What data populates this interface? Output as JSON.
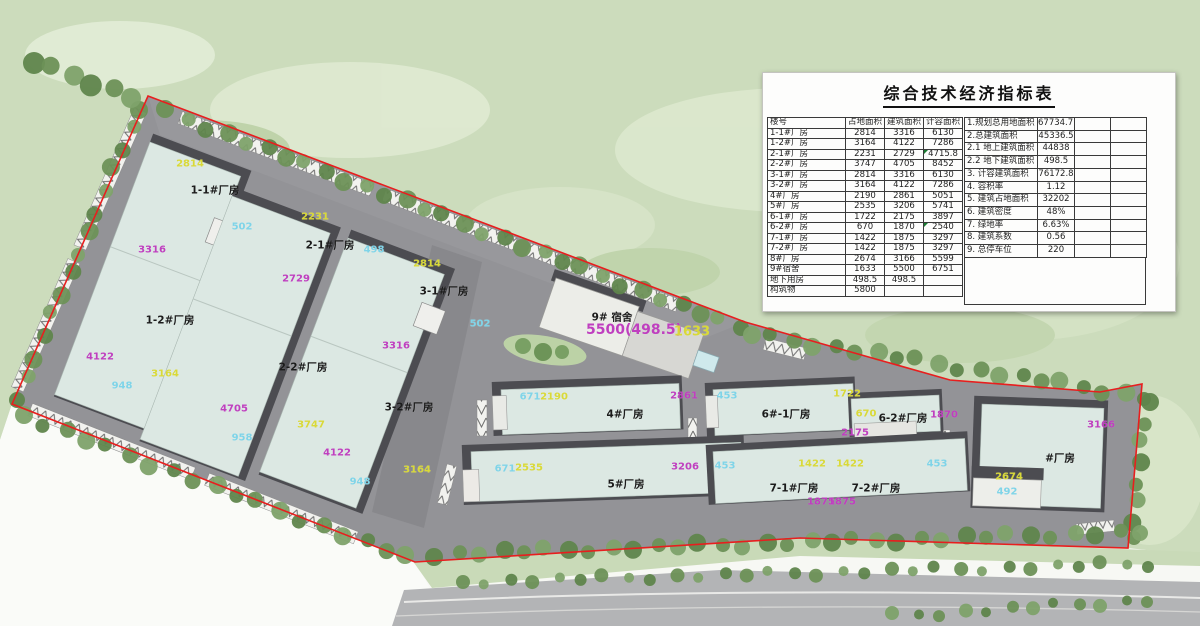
{
  "indicator_table": {
    "title": "综合技术经济指标表",
    "building_table": {
      "headers": [
        "楼号",
        "占地面积",
        "建筑面积",
        "计容面积"
      ],
      "rows": [
        [
          "1-1#厂房",
          "2814",
          "3316",
          "6130"
        ],
        [
          "1-2#厂房",
          "3164",
          "4122",
          "7286"
        ],
        [
          "2-1#厂房",
          "2231",
          "2729",
          "4715.8"
        ],
        [
          "2-2#厂房",
          "3747",
          "4705",
          "8452"
        ],
        [
          "3-1#厂房",
          "2814",
          "3316",
          "6130"
        ],
        [
          "3-2#厂房",
          "3164",
          "4122",
          "7286"
        ],
        [
          "4#厂房",
          "2190",
          "2861",
          "5051"
        ],
        [
          "5#厂房",
          "2535",
          "3206",
          "5741"
        ],
        [
          "6-1#厂房",
          "1722",
          "2175",
          "3897"
        ],
        [
          "6-2#厂房",
          "670",
          "1870",
          "2540"
        ],
        [
          "7-1#厂房",
          "1422",
          "1875",
          "3297"
        ],
        [
          "7-2#厂房",
          "1422",
          "1875",
          "3297"
        ],
        [
          "8#厂房",
          "2674",
          "3166",
          "5599"
        ],
        [
          "9#宿舍",
          "1633",
          "5500",
          "6751"
        ],
        [
          "地下用房",
          "498.5",
          "498.5",
          ""
        ],
        [
          "构筑物",
          "5800",
          "",
          ""
        ]
      ],
      "flagged_cells": [
        [
          2,
          3
        ],
        [
          9,
          3
        ]
      ]
    },
    "summary_table": {
      "rows": [
        [
          "1.规划总用地面积",
          "67734.71"
        ],
        [
          "2.总建筑面积",
          "45336.5"
        ],
        [
          "2.1 地上建筑面积",
          "44838"
        ],
        [
          "2.2 地下建筑面积",
          "498.5"
        ],
        [
          "3. 计容建筑面积",
          "76172.8"
        ],
        [
          "4. 容积率",
          "1.12"
        ],
        [
          "5. 建筑占地面积",
          "32202"
        ],
        [
          "6. 建筑密度",
          "48%"
        ],
        [
          "7. 绿地率",
          "6.63%"
        ],
        [
          "8. 建筑系数",
          "0.56"
        ],
        [
          "9. 总停车位",
          "220"
        ]
      ]
    }
  },
  "plan": {
    "label_colors": {
      "yellow": "#d9d938",
      "magenta": "#bf3fbf",
      "cyan": "#7fd4e8",
      "black": "#1b1b1b"
    },
    "boundary_color": "#e81e1e",
    "labels": [
      {
        "name": "footprint-area-label",
        "text": "2814",
        "x": 190,
        "y": 164,
        "color": "yellow"
      },
      {
        "name": "building-name-label",
        "text": "1-1#厂房",
        "x": 215,
        "y": 190,
        "color": "black"
      },
      {
        "name": "floor-area-label",
        "text": "3316",
        "x": 152,
        "y": 250,
        "color": "magenta"
      },
      {
        "name": "aux-area-label",
        "text": "502",
        "x": 242,
        "y": 227,
        "color": "cyan"
      },
      {
        "name": "building-name-label",
        "text": "1-2#厂房",
        "x": 170,
        "y": 320,
        "color": "black"
      },
      {
        "name": "floor-area-label",
        "text": "4122",
        "x": 100,
        "y": 357,
        "color": "magenta"
      },
      {
        "name": "footprint-area-label",
        "text": "3164",
        "x": 165,
        "y": 374,
        "color": "yellow"
      },
      {
        "name": "aux-area-label",
        "text": "948",
        "x": 122,
        "y": 386,
        "color": "cyan"
      },
      {
        "name": "footprint-area-label",
        "text": "2231",
        "x": 315,
        "y": 217,
        "color": "yellow"
      },
      {
        "name": "building-name-label",
        "text": "2-1#厂房",
        "x": 330,
        "y": 245,
        "color": "black"
      },
      {
        "name": "aux-area-label",
        "text": "498",
        "x": 374,
        "y": 250,
        "color": "cyan"
      },
      {
        "name": "floor-area-label",
        "text": "2729",
        "x": 296,
        "y": 279,
        "color": "magenta"
      },
      {
        "name": "building-name-label",
        "text": "2-2#厂房",
        "x": 303,
        "y": 367,
        "color": "black"
      },
      {
        "name": "footprint-area-label",
        "text": "3747",
        "x": 311,
        "y": 425,
        "color": "yellow"
      },
      {
        "name": "floor-area-label",
        "text": "4705",
        "x": 234,
        "y": 409,
        "color": "magenta"
      },
      {
        "name": "aux-area-label",
        "text": "958",
        "x": 242,
        "y": 438,
        "color": "cyan"
      },
      {
        "name": "footprint-area-label",
        "text": "2814",
        "x": 427,
        "y": 264,
        "color": "yellow"
      },
      {
        "name": "building-name-label",
        "text": "3-1#厂房",
        "x": 444,
        "y": 291,
        "color": "black"
      },
      {
        "name": "aux-area-label",
        "text": "502",
        "x": 480,
        "y": 324,
        "color": "cyan"
      },
      {
        "name": "floor-area-label",
        "text": "3316",
        "x": 396,
        "y": 346,
        "color": "magenta"
      },
      {
        "name": "building-name-label",
        "text": "3-2#厂房",
        "x": 409,
        "y": 407,
        "color": "black"
      },
      {
        "name": "floor-area-label",
        "text": "4122",
        "x": 337,
        "y": 453,
        "color": "magenta"
      },
      {
        "name": "footprint-area-label",
        "text": "3164",
        "x": 417,
        "y": 470,
        "color": "yellow"
      },
      {
        "name": "aux-area-label",
        "text": "948",
        "x": 360,
        "y": 482,
        "color": "cyan"
      },
      {
        "name": "building-name-label",
        "text": "9# 宿舍",
        "x": 612,
        "y": 317,
        "color": "black"
      },
      {
        "name": "floor-area-label",
        "text": "5500(498.5)",
        "x": 634,
        "y": 330,
        "color": "magenta",
        "size": 14
      },
      {
        "name": "footprint-area-label",
        "text": "1633",
        "x": 692,
        "y": 332,
        "color": "yellow",
        "size": 13
      },
      {
        "name": "aux-area-label",
        "text": "671",
        "x": 530,
        "y": 397,
        "color": "cyan"
      },
      {
        "name": "footprint-area-label",
        "text": "2190",
        "x": 554,
        "y": 397,
        "color": "yellow"
      },
      {
        "name": "floor-area-label",
        "text": "2861",
        "x": 684,
        "y": 396,
        "color": "magenta"
      },
      {
        "name": "building-name-label",
        "text": "4#厂房",
        "x": 625,
        "y": 414,
        "color": "black"
      },
      {
        "name": "aux-area-label",
        "text": "453",
        "x": 727,
        "y": 396,
        "color": "cyan"
      },
      {
        "name": "footprint-area-label",
        "text": "1722",
        "x": 847,
        "y": 394,
        "color": "yellow"
      },
      {
        "name": "building-name-label",
        "text": "6#-1厂房",
        "x": 786,
        "y": 414,
        "color": "black"
      },
      {
        "name": "footprint-area-label",
        "text": "670",
        "x": 866,
        "y": 414,
        "color": "yellow"
      },
      {
        "name": "building-name-label",
        "text": "6-2#厂房",
        "x": 903,
        "y": 418,
        "color": "black"
      },
      {
        "name": "floor-area-label",
        "text": "1870",
        "x": 944,
        "y": 415,
        "color": "magenta"
      },
      {
        "name": "floor-area-label",
        "text": "2175",
        "x": 855,
        "y": 433,
        "color": "magenta"
      },
      {
        "name": "aux-area-label",
        "text": "671",
        "x": 505,
        "y": 469,
        "color": "cyan"
      },
      {
        "name": "footprint-area-label",
        "text": "2535",
        "x": 529,
        "y": 468,
        "color": "yellow"
      },
      {
        "name": "floor-area-label",
        "text": "3206",
        "x": 685,
        "y": 467,
        "color": "magenta"
      },
      {
        "name": "building-name-label",
        "text": "5#厂房",
        "x": 626,
        "y": 484,
        "color": "black"
      },
      {
        "name": "aux-area-label",
        "text": "453",
        "x": 725,
        "y": 466,
        "color": "cyan"
      },
      {
        "name": "footprint-area-label",
        "text": "1422",
        "x": 812,
        "y": 464,
        "color": "yellow"
      },
      {
        "name": "footprint-area-label",
        "text": "1422",
        "x": 850,
        "y": 464,
        "color": "yellow"
      },
      {
        "name": "building-name-label",
        "text": "7-1#厂房",
        "x": 794,
        "y": 488,
        "color": "black"
      },
      {
        "name": "building-name-label",
        "text": "7-2#厂房",
        "x": 876,
        "y": 488,
        "color": "black"
      },
      {
        "name": "floor-area-label",
        "text": "1875",
        "x": 821,
        "y": 502,
        "color": "magenta"
      },
      {
        "name": "floor-area-label",
        "text": "1875",
        "x": 842,
        "y": 502,
        "color": "magenta"
      },
      {
        "name": "aux-area-label",
        "text": "453",
        "x": 937,
        "y": 464,
        "color": "cyan"
      },
      {
        "name": "floor-area-label",
        "text": "3166",
        "x": 1101,
        "y": 425,
        "color": "magenta"
      },
      {
        "name": "building-name-label",
        "text": "#厂房",
        "x": 1060,
        "y": 458,
        "color": "black"
      },
      {
        "name": "footprint-area-label",
        "text": "2674",
        "x": 1009,
        "y": 477,
        "color": "yellow"
      },
      {
        "name": "aux-area-label",
        "text": "492",
        "x": 1007,
        "y": 492,
        "color": "cyan"
      }
    ]
  }
}
